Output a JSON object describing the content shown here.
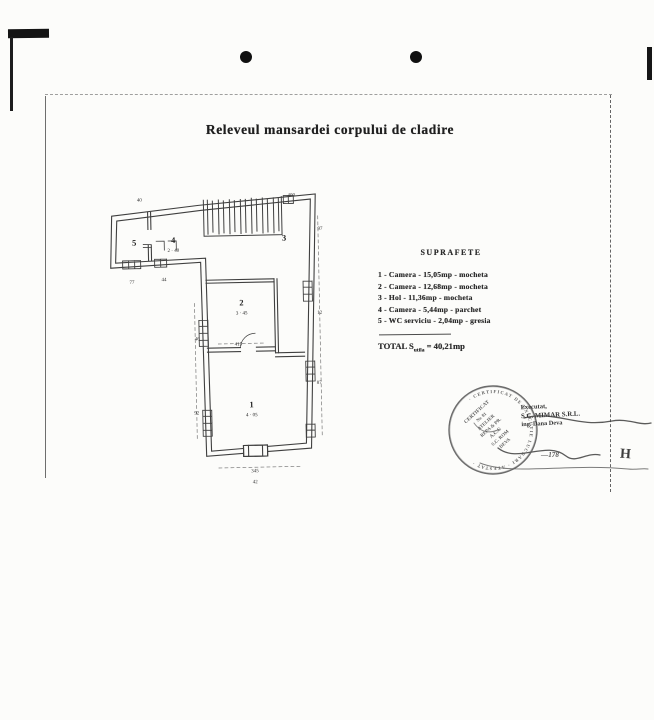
{
  "title": "Releveul mansardei corpului de cladire",
  "legend": {
    "header": "SUPRAFETE",
    "items": [
      "1 - Camera - 15,05mp - mocheta",
      "2 - Camera - 12,68mp - mocheta",
      "3 - Hol - 11,36mp - mocheta",
      "4 - Camera - 5,44mp - parchet",
      "5 - WC serviciu - 2,04mp - gresia"
    ],
    "total_prefix": "TOTAL S",
    "total_sub": "utila",
    "total_value": " = 40,21mp"
  },
  "plan": {
    "rooms": [
      {
        "label": "1",
        "dim": "4 · 05"
      },
      {
        "label": "2",
        "dim": "3 · 45"
      },
      {
        "label": "3",
        "dim": ""
      },
      {
        "label": "4",
        "dim": "2 · 40"
      },
      {
        "label": "5",
        "dim": ""
      }
    ],
    "dims": [
      "415",
      "345",
      "400",
      "97",
      "12",
      "87",
      "46",
      "92",
      "44",
      "77",
      "40",
      "42"
    ]
  },
  "stamp": {
    "ring": "· CERTIFICAT DE EXECUTIE LUCRARI · ATESTAT ·",
    "lines": [
      "CERTIFICAT",
      "Nr. 81",
      "ATELIER",
      "REPA & PR.",
      "A.C.C",
      "S.C. ROM",
      "DEVA"
    ],
    "number": "—178",
    "exec": [
      "Executat,",
      "S.C. MIMAR S.R.L.",
      "ing. Dana Deva"
    ]
  },
  "margin_mark": "H",
  "colors": {
    "ink": "#222222",
    "paper": "#fcfcfa"
  }
}
